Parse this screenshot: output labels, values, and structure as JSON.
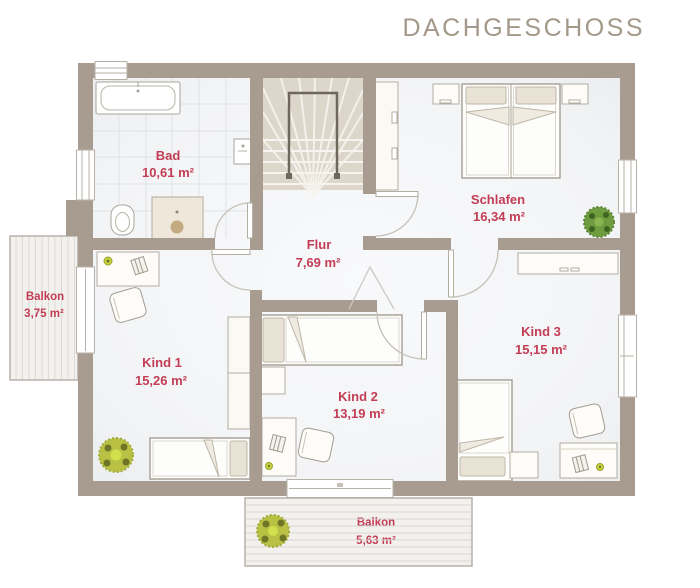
{
  "title": "DACHGESCHOSS",
  "colors": {
    "wall": "#a79c8f",
    "room_label": "#c23d55",
    "title": "#a39889",
    "stair_floor": "#ddd6ca",
    "tile_line": "#dfe2e6",
    "balcony_line": "#dcdad5",
    "plant_green": "#6f9c3f",
    "plant_yellow_green": "#b9c145"
  },
  "rooms": [
    {
      "id": "bad",
      "name": "Bad",
      "area": "10,61 m²"
    },
    {
      "id": "schlafen",
      "name": "Schlafen",
      "area": "16,34 m²"
    },
    {
      "id": "flur",
      "name": "Flur",
      "area": "7,69 m²"
    },
    {
      "id": "kind1",
      "name": "Kind 1",
      "area": "15,26 m²"
    },
    {
      "id": "kind2",
      "name": "Kind 2",
      "area": "13,19 m²"
    },
    {
      "id": "kind3",
      "name": "Kind 3",
      "area": "15,15 m²"
    },
    {
      "id": "balkon-west",
      "name": "Balkon",
      "area": "3,75 m²"
    },
    {
      "id": "balkon-sued",
      "name": "Balkon",
      "area": "5,63 m²"
    }
  ]
}
